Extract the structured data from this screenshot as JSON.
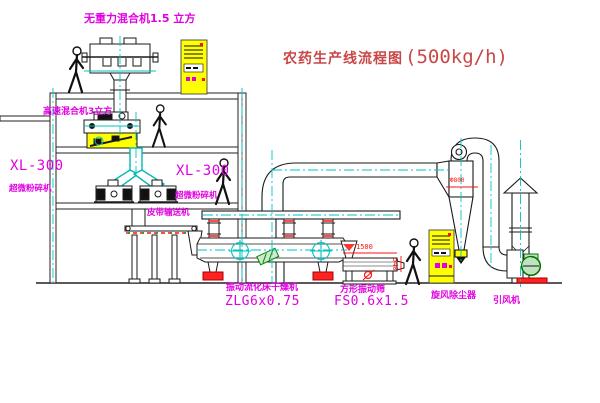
{
  "title": {
    "cn": "农药生产线流程图",
    "capacity": "(500kg/h)"
  },
  "labels": {
    "top_mixer": "无重力混合机1.5 立方",
    "high_speed_mixer": "高速混合机3立方",
    "xl300_left": {
      "model": "XL-300",
      "name": "超微粉碎机"
    },
    "xl300_right": {
      "model": "XL-300",
      "name": "超微粉碎机"
    },
    "belt_conveyor": "皮带输送机",
    "dryer": {
      "name": "振动流化床干燥机",
      "model": "ZLG6x0.75"
    },
    "sieve": {
      "name": "方形振动筛",
      "model": "FS0.6x1.5"
    },
    "cyclone": "旋风除尘器",
    "fan": "引风机"
  },
  "dimensions": {
    "cyclone_dia": "Ф800",
    "sieve_length": "1500",
    "sieve_width": "540"
  },
  "colors": {
    "label_magenta": "#e100e1",
    "title_red": "#c84848",
    "line_black": "#1a1a1a",
    "centerline_cyan": "#00c3c3",
    "accent_red": "#ff1010",
    "cabinet_yellow": "#ffff00",
    "machine_green": "#008800"
  }
}
